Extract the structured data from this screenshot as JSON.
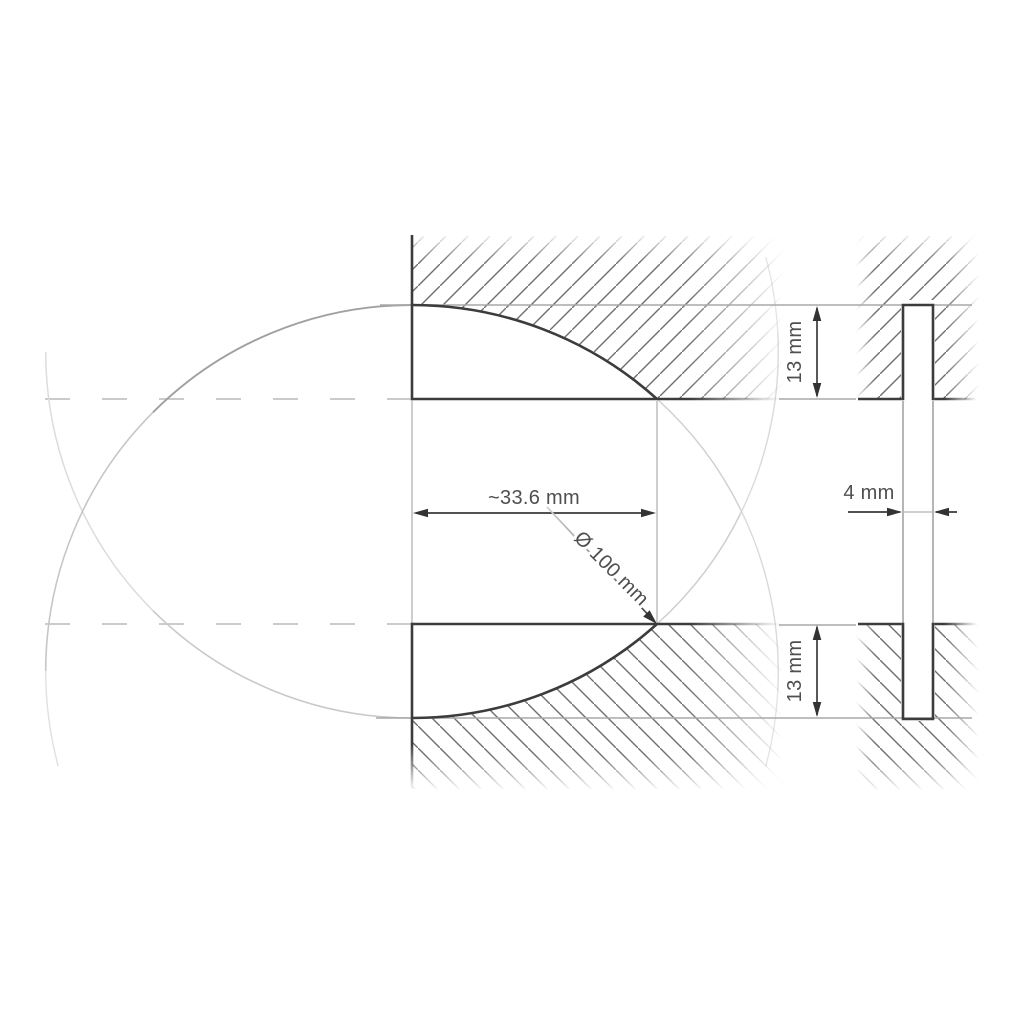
{
  "drawing": {
    "type": "technical cross-section drawing of spherical lens mold cavity and flat window mount",
    "labels": {
      "width": "~33.6 mm",
      "diameter": "Ø 100 mm",
      "gap_top": "13 mm",
      "gap_bottom": "13 mm",
      "window_thickness": "4 mm"
    },
    "values": {
      "width_mm": 33.6,
      "sphere_diameter_mm": 100,
      "gap_top_mm": 13,
      "gap_bottom_mm": 13,
      "window_thickness_mm": 4
    },
    "colors": {
      "background": "#ffffff",
      "outline": "#3c3c3c",
      "hatch": "#6f6f6f",
      "dimension_line": "#3a3a3a",
      "arrow": "#333333",
      "label_text": "#4f4f4f",
      "construction_light": "#d2d2d2",
      "construction_dark": "#a0a0a0",
      "centerline": "#cbcbcb",
      "extension_line": "#a8a8a8"
    }
  }
}
